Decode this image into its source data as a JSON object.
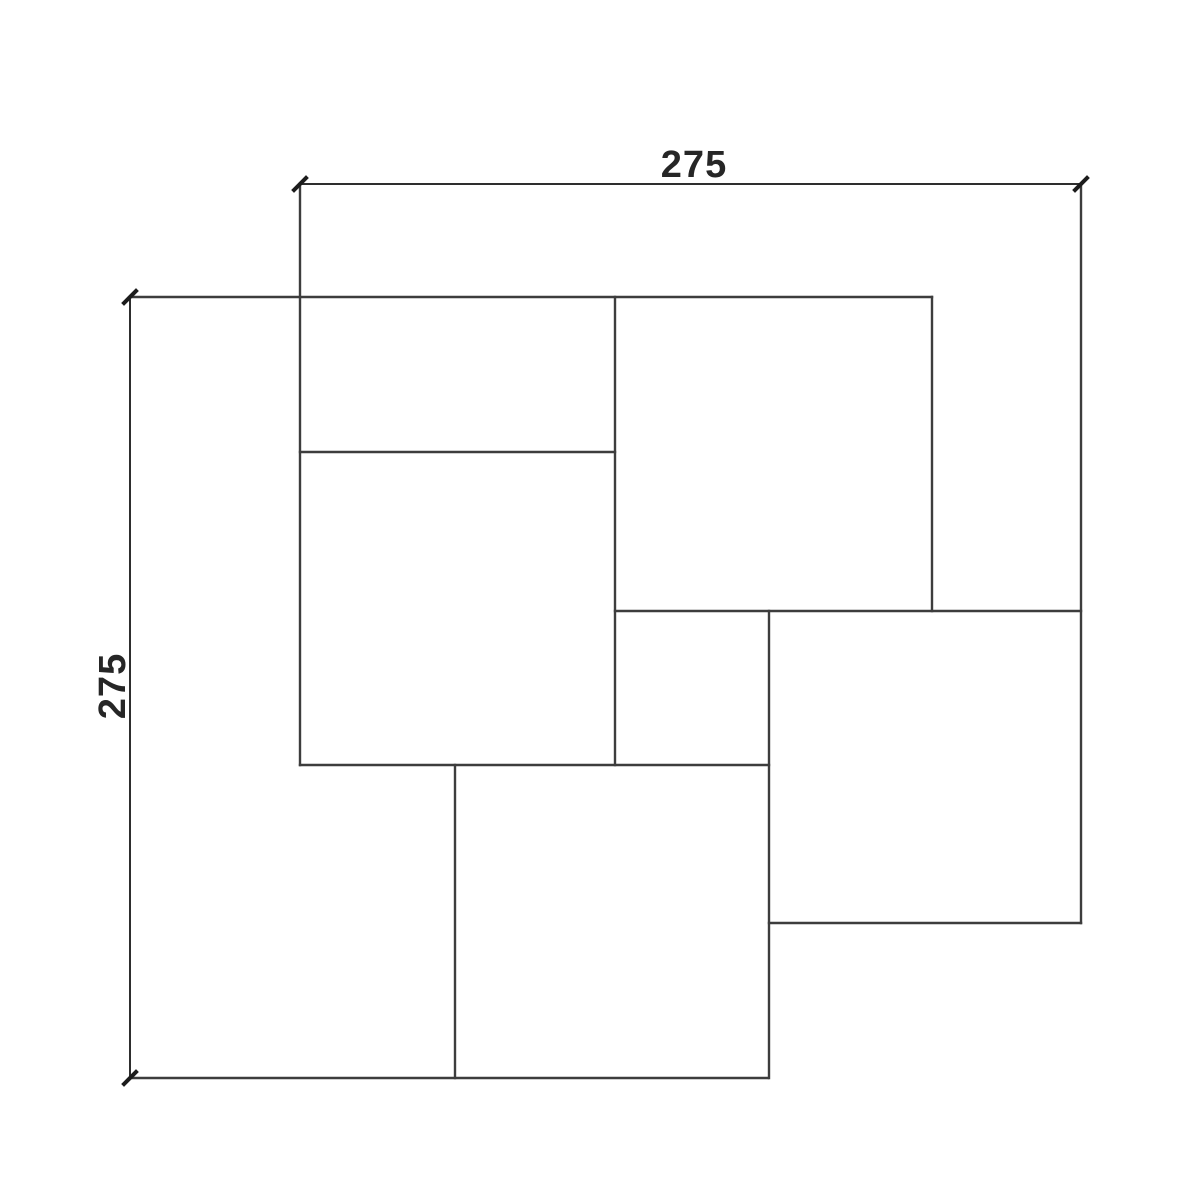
{
  "drawing": {
    "type": "technical-dimension-drawing",
    "background": "#ffffff",
    "line_color": "#3d3d3d",
    "dim_line_color": "#2e2e2e",
    "tick_color": "#1c1c1c",
    "text_color": "#262626",
    "line_width": 2.4,
    "dim_line_width": 2,
    "tick_width": 4,
    "dimensions": {
      "horizontal": {
        "label": "275",
        "x1": 300,
        "x2": 1081,
        "y": 184
      },
      "vertical": {
        "label": "275",
        "y1": 297,
        "y2": 1078,
        "x": 130
      }
    },
    "dim_segments": [
      {
        "name": "top-dimension-line",
        "x1": 300,
        "y1": 184,
        "x2": 1081,
        "y2": 184
      },
      {
        "name": "left-dimension-line",
        "x1": 130,
        "y1": 297,
        "x2": 130,
        "y2": 1078
      }
    ],
    "ticks": [
      {
        "name": "tick-top-dim-left",
        "x": 300,
        "y": 184
      },
      {
        "name": "tick-top-dim-right",
        "x": 1081,
        "y": 184
      },
      {
        "name": "tick-left-dim-top",
        "x": 130,
        "y": 297
      },
      {
        "name": "tick-left-dim-bottom",
        "x": 130,
        "y": 1078
      }
    ],
    "segments": [
      {
        "name": "edge-top",
        "x1": 130,
        "y1": 297,
        "x2": 932,
        "y2": 297
      },
      {
        "name": "edge-topleft-rect-bottom",
        "x1": 300,
        "y1": 452,
        "x2": 615,
        "y2": 452
      },
      {
        "name": "edge-right-square-top",
        "x1": 615,
        "y1": 611,
        "x2": 1081,
        "y2": 611
      },
      {
        "name": "edge-left-square-bottom",
        "x1": 300,
        "y1": 765,
        "x2": 769,
        "y2": 765
      },
      {
        "name": "edge-right-square-bottom",
        "x1": 769,
        "y1": 923,
        "x2": 1081,
        "y2": 923
      },
      {
        "name": "edge-bottom",
        "x1": 130,
        "y1": 1078,
        "x2": 768,
        "y2": 1078
      },
      {
        "name": "edge-left-extension",
        "x1": 300,
        "y1": 184,
        "x2": 300,
        "y2": 765
      },
      {
        "name": "edge-bottom-square-left",
        "x1": 455,
        "y1": 765,
        "x2": 455,
        "y2": 1078
      },
      {
        "name": "edge-center-vertical",
        "x1": 615,
        "y1": 297,
        "x2": 615,
        "y2": 765
      },
      {
        "name": "edge-bottom-square-right",
        "x1": 769,
        "y1": 611,
        "x2": 769,
        "y2": 1078
      },
      {
        "name": "edge-topright-square-right",
        "x1": 932,
        "y1": 297,
        "x2": 932,
        "y2": 611
      },
      {
        "name": "edge-right-extension",
        "x1": 1081,
        "y1": 184,
        "x2": 1081,
        "y2": 923
      }
    ],
    "pieces": [
      {
        "name": "paver-top-left-rectangle",
        "x": 300,
        "y": 297,
        "w": 315,
        "h": 155
      },
      {
        "name": "paver-left-square",
        "x": 300,
        "y": 452,
        "w": 315,
        "h": 313
      },
      {
        "name": "paver-top-right-square",
        "x": 615,
        "y": 297,
        "w": 317,
        "h": 314
      },
      {
        "name": "paver-center-small-square",
        "x": 615,
        "y": 611,
        "w": 154,
        "h": 154
      },
      {
        "name": "paver-right-square",
        "x": 769,
        "y": 611,
        "w": 312,
        "h": 312
      },
      {
        "name": "paver-bottom-square",
        "x": 455,
        "y": 765,
        "w": 313,
        "h": 313
      }
    ]
  }
}
